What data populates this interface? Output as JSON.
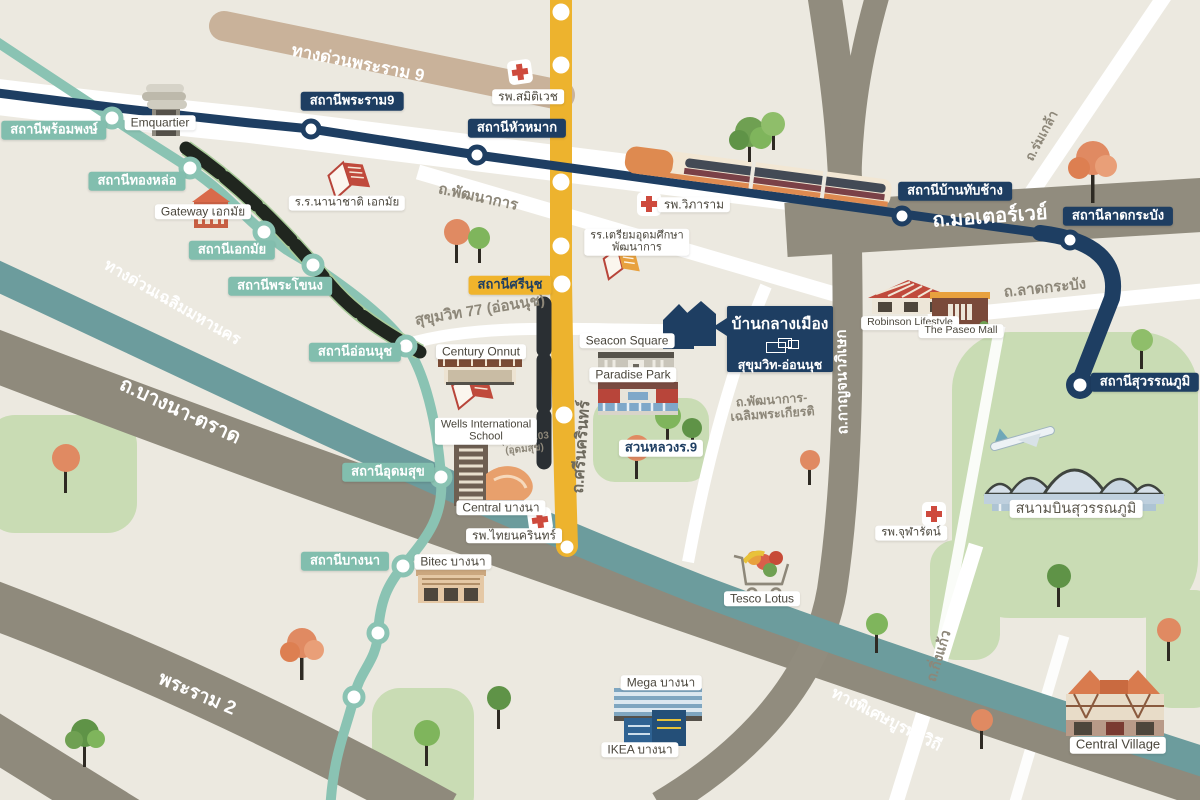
{
  "colors": {
    "background": "#ECE9E0",
    "navy": "#1E3E62",
    "bts_teal": "#8AC3B3",
    "teal_expwy": "#6C9C9D",
    "yellow_line": "#EDB32E",
    "gray_road": "#918C7E",
    "tan_road": "#C9B29A",
    "green_area": "#C9DCB4",
    "red_cross": "#CE4A3D",
    "street_text": "#8D8779"
  },
  "stations": {
    "teal": [
      {
        "label": "สถานีพร้อมพงษ์"
      },
      {
        "label": "สถานีทองหล่อ"
      },
      {
        "label": "สถานีเอกมัย"
      },
      {
        "label": "สถานีพระโขนง"
      },
      {
        "label": "สถานีอ่อนนุช"
      },
      {
        "label": "สถานีอุดมสุข"
      },
      {
        "label": "สถานีบางนา"
      }
    ],
    "navy": [
      {
        "label": "สถานีพระราม9"
      },
      {
        "label": "สถานีหัวหมาก"
      },
      {
        "label": "สถานีบ้านทับช้าง"
      },
      {
        "label": "สถานีลาดกระบัง"
      },
      {
        "label": "สถานีสุวรรณภูมิ"
      }
    ],
    "yellow": [
      {
        "label": "สถานีศรีนุช"
      }
    ]
  },
  "highways": {
    "rama9": "ทางด่วนพระราม 9",
    "motorway": "ถ.มอเตอร์เวย์",
    "chalerm": "ทางด่วนเฉลิมมหานคร",
    "bangna_trad": "ถ.บางนา-ตราด",
    "rama2": "พระราม 2",
    "burapha": "ทางพิเศษบูรพาวิถี",
    "kanchana": "ถ.กาญจนาภิเษก"
  },
  "streets": {
    "pattanakarn": "ถ.พัฒนาการ",
    "suk77": "สุขุมวิท 77 (อ่อนนุช)",
    "suk103_1": "สุขุมวิท 103",
    "suk103_2": "(อุดมสุข)",
    "srinakarin": "ถ.ศรีนครินทร์",
    "latkrabang": "ถ.ลาดกระบัง",
    "romklao": "ถ.ร่มเกล้า",
    "kingkaew": "ถ.กิ่งแก้ว",
    "patt_chalerm_1": "ถ.พัฒนาการ-",
    "patt_chalerm_2": "เฉลิมพระเกียรติ"
  },
  "places": {
    "emquartier": "Emquartier",
    "gateway": "Gateway เอกมัย",
    "ekkamai_school": "ร.ร.นานาชาติ เอกมัย",
    "century": "Century Onnut",
    "wells_1": "Wells International",
    "wells_2": "School",
    "triam_1": "รร.เตรียมอุดมศึกษา",
    "triam_2": "พัฒนาการ",
    "seacon": "Seacon Square",
    "paradise": "Paradise Park",
    "suanluang": "สวนหลวงร.9",
    "central_bangna": "Central บางนา",
    "bitec": "Bitec บางนา",
    "tesco": "Tesco Lotus",
    "mega": "Mega บางนา",
    "ikea": "IKEA บางนา",
    "robinson": "Robinson Lifestyle",
    "paseo": "The Paseo Mall",
    "airport": "สนามบินสุวรรณภูมิ",
    "central_village": "Central Village"
  },
  "hospitals": {
    "samitivej": "รพ.สมิติเวช",
    "vibharam": "รพ.วิภาราม",
    "thainakarin": "รพ.ไทยนครินทร์",
    "chularat": "รพ.จุฬารัตน์"
  },
  "callout": {
    "title": "บ้านกลางเมือง",
    "subtitle": "สุขุมวิท-อ่อนนุช"
  }
}
